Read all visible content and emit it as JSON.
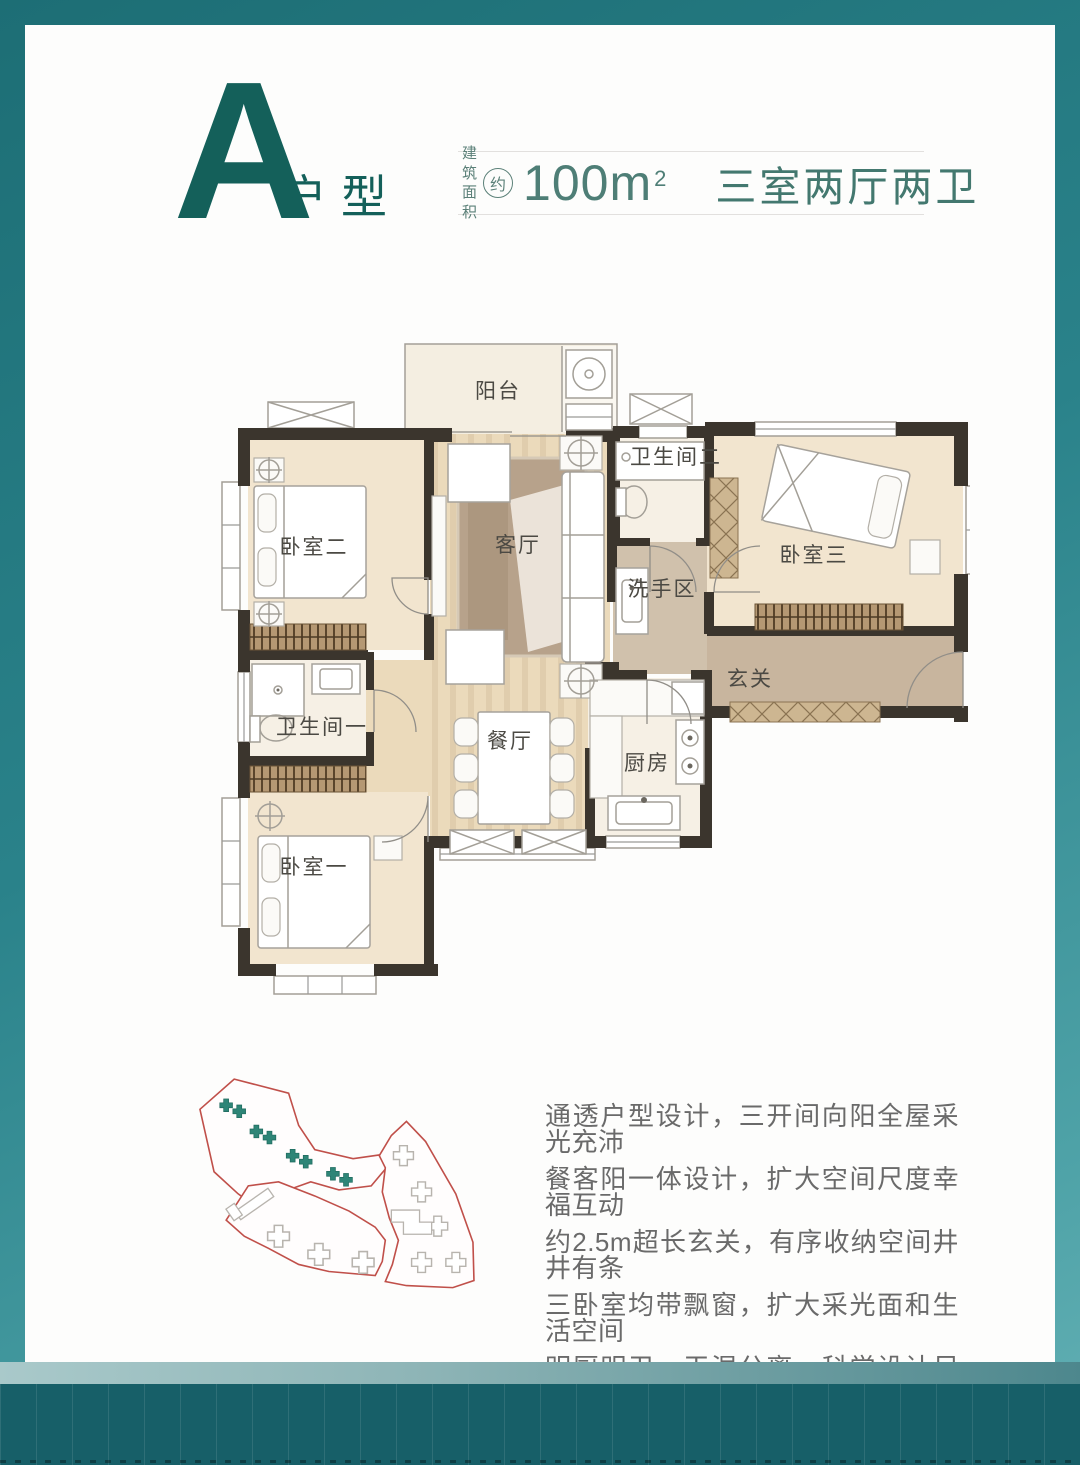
{
  "header": {
    "unit_letter": "A",
    "unit_label": "户型",
    "area_prefix_top": "建筑",
    "area_prefix_bottom": "面积",
    "area_circle": "约",
    "area_value": "100m",
    "area_sup": "2",
    "layout_label": "三室两厅两卫",
    "accent_color": "#14605a",
    "banner_text_color": "#4e7e76"
  },
  "floorplan": {
    "label_color": "#4b4943",
    "wall_color": "#3b352d",
    "rooms": [
      {
        "id": "balcony",
        "label": "阳台"
      },
      {
        "id": "bedroom-2",
        "label": "卧室二"
      },
      {
        "id": "living-room",
        "label": "客厅"
      },
      {
        "id": "bathroom-2",
        "label": "卫生间二"
      },
      {
        "id": "bedroom-3",
        "label": "卧室三"
      },
      {
        "id": "wash-area",
        "label": "洗手区"
      },
      {
        "id": "foyer",
        "label": "玄关"
      },
      {
        "id": "bathroom-1",
        "label": "卫生间一"
      },
      {
        "id": "dining-room",
        "label": "餐厅"
      },
      {
        "id": "kitchen",
        "label": "厨房"
      },
      {
        "id": "bedroom-1",
        "label": "卧室一"
      }
    ]
  },
  "description": {
    "text_color": "#6a6a6a",
    "lines": [
      "通透户型设计，三开间向阳全屋采光充沛",
      "餐客阳一体设计，扩大空间尺度幸福互动",
      "约2.5m超长玄关，有序收纳空间井井有条",
      "三卧室均带飘窗，扩大采光面和生活空间",
      "明厨明卫，干湿分离，科学设计尽享舒居"
    ]
  },
  "frame": {
    "border_gradient": [
      "#1d6e75",
      "#2a828a",
      "#63b0b4"
    ],
    "bottom_band_color": "#175f68",
    "card_color": "#fdfdfc",
    "siteplan_outline_color": "#c0504a",
    "siteplan_highlight_color": "#2e8577"
  }
}
